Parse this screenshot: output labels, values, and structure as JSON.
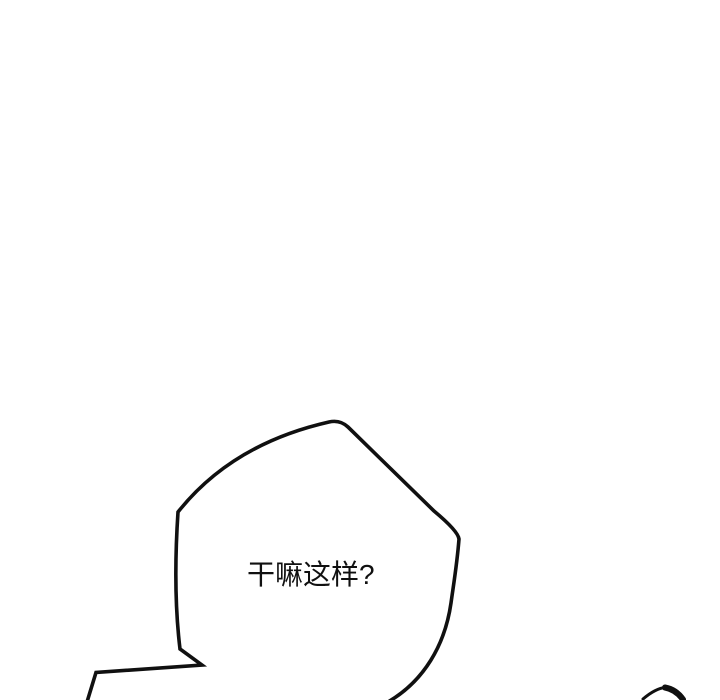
{
  "panel": {
    "background": "#ffffff",
    "ink_color": "#101010",
    "speech_bubble": {
      "text": "干嘛这样?"
    }
  }
}
